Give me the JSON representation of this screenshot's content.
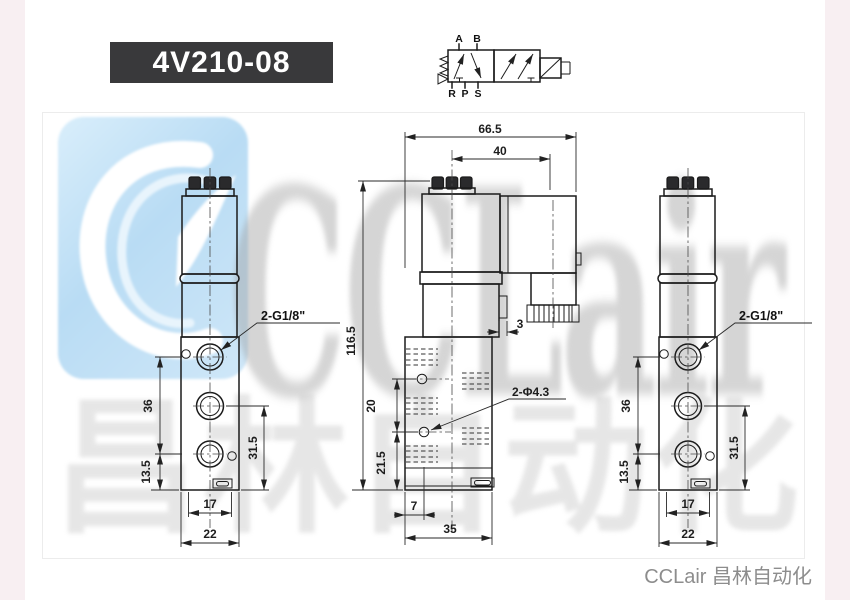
{
  "title": {
    "product_code": "4V210-08"
  },
  "schematic": {
    "ports_top": [
      "A",
      "B"
    ],
    "ports_bottom": [
      "R",
      "P",
      "S"
    ]
  },
  "views": {
    "left": {
      "thread_label": "2-G1/8\"",
      "dims": {
        "d36": "36",
        "d13_5": "13.5",
        "d31_5": "31.5",
        "d17": "17",
        "d22": "22"
      }
    },
    "middle": {
      "hole_label": "2-Φ4.3",
      "dims": {
        "d66_5": "66.5",
        "d40": "40",
        "d116_5": "116.5",
        "d3": "3",
        "d20": "20",
        "d21_5": "21.5",
        "d7": "7",
        "d35": "35"
      }
    },
    "right": {
      "thread_label": "2-G1/8\"",
      "dims": {
        "d36": "36",
        "d13_5": "13.5",
        "d31_5": "31.5",
        "d17": "17",
        "d22": "22"
      }
    }
  },
  "watermark": {
    "brand": "CCLair",
    "brand_cn": "昌林自动化"
  },
  "footer": {
    "caption": "CCLair 昌林自动化"
  },
  "colors": {
    "title_bg": "#39393b",
    "line": "#1b1b1b",
    "watermark_blue": "#b9dcf4",
    "caption_gray": "#8d8d8d",
    "margin_pink": "#f8eff2"
  }
}
